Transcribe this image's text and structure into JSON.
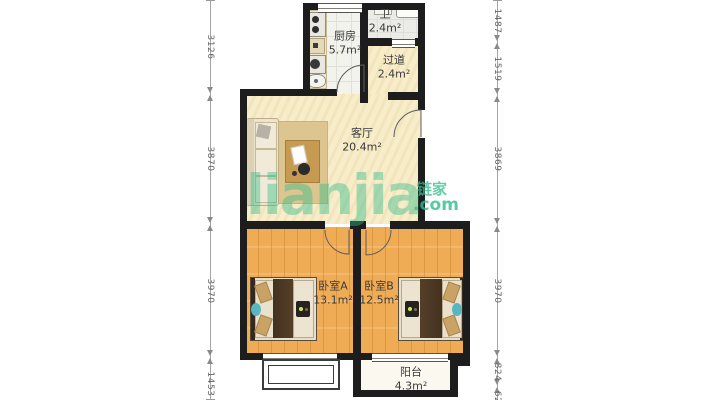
{
  "watermark": {
    "brand_latin": "lianjia",
    "brand_cn": "链家",
    "suffix": ".com",
    "color": "#2fbd8a"
  },
  "rooms": [
    {
      "name": "厨房",
      "area": "5.7m²"
    },
    {
      "name": "卫",
      "area": "2.4m²"
    },
    {
      "name": "过道",
      "area": "2.4m²"
    },
    {
      "name": "客厅",
      "area": "20.4m²"
    },
    {
      "name": "卧室A",
      "area": "13.1m²"
    },
    {
      "name": "卧室B",
      "area": "12.5m²"
    },
    {
      "name": "阳台",
      "area": "4.3m²"
    }
  ],
  "dimensions_mm": {
    "left": [
      "3126",
      "3870",
      "3970",
      "1453"
    ],
    "right": [
      "1487",
      "1519",
      "3869",
      "3970",
      "824",
      "62"
    ]
  },
  "colors": {
    "wall": "#1d1d1d",
    "floor_cream": "#f7edcb",
    "floor_wood": "#f0ac55",
    "floor_tile": "#f3f3ee",
    "watermark_green": "#2fbd8a"
  }
}
